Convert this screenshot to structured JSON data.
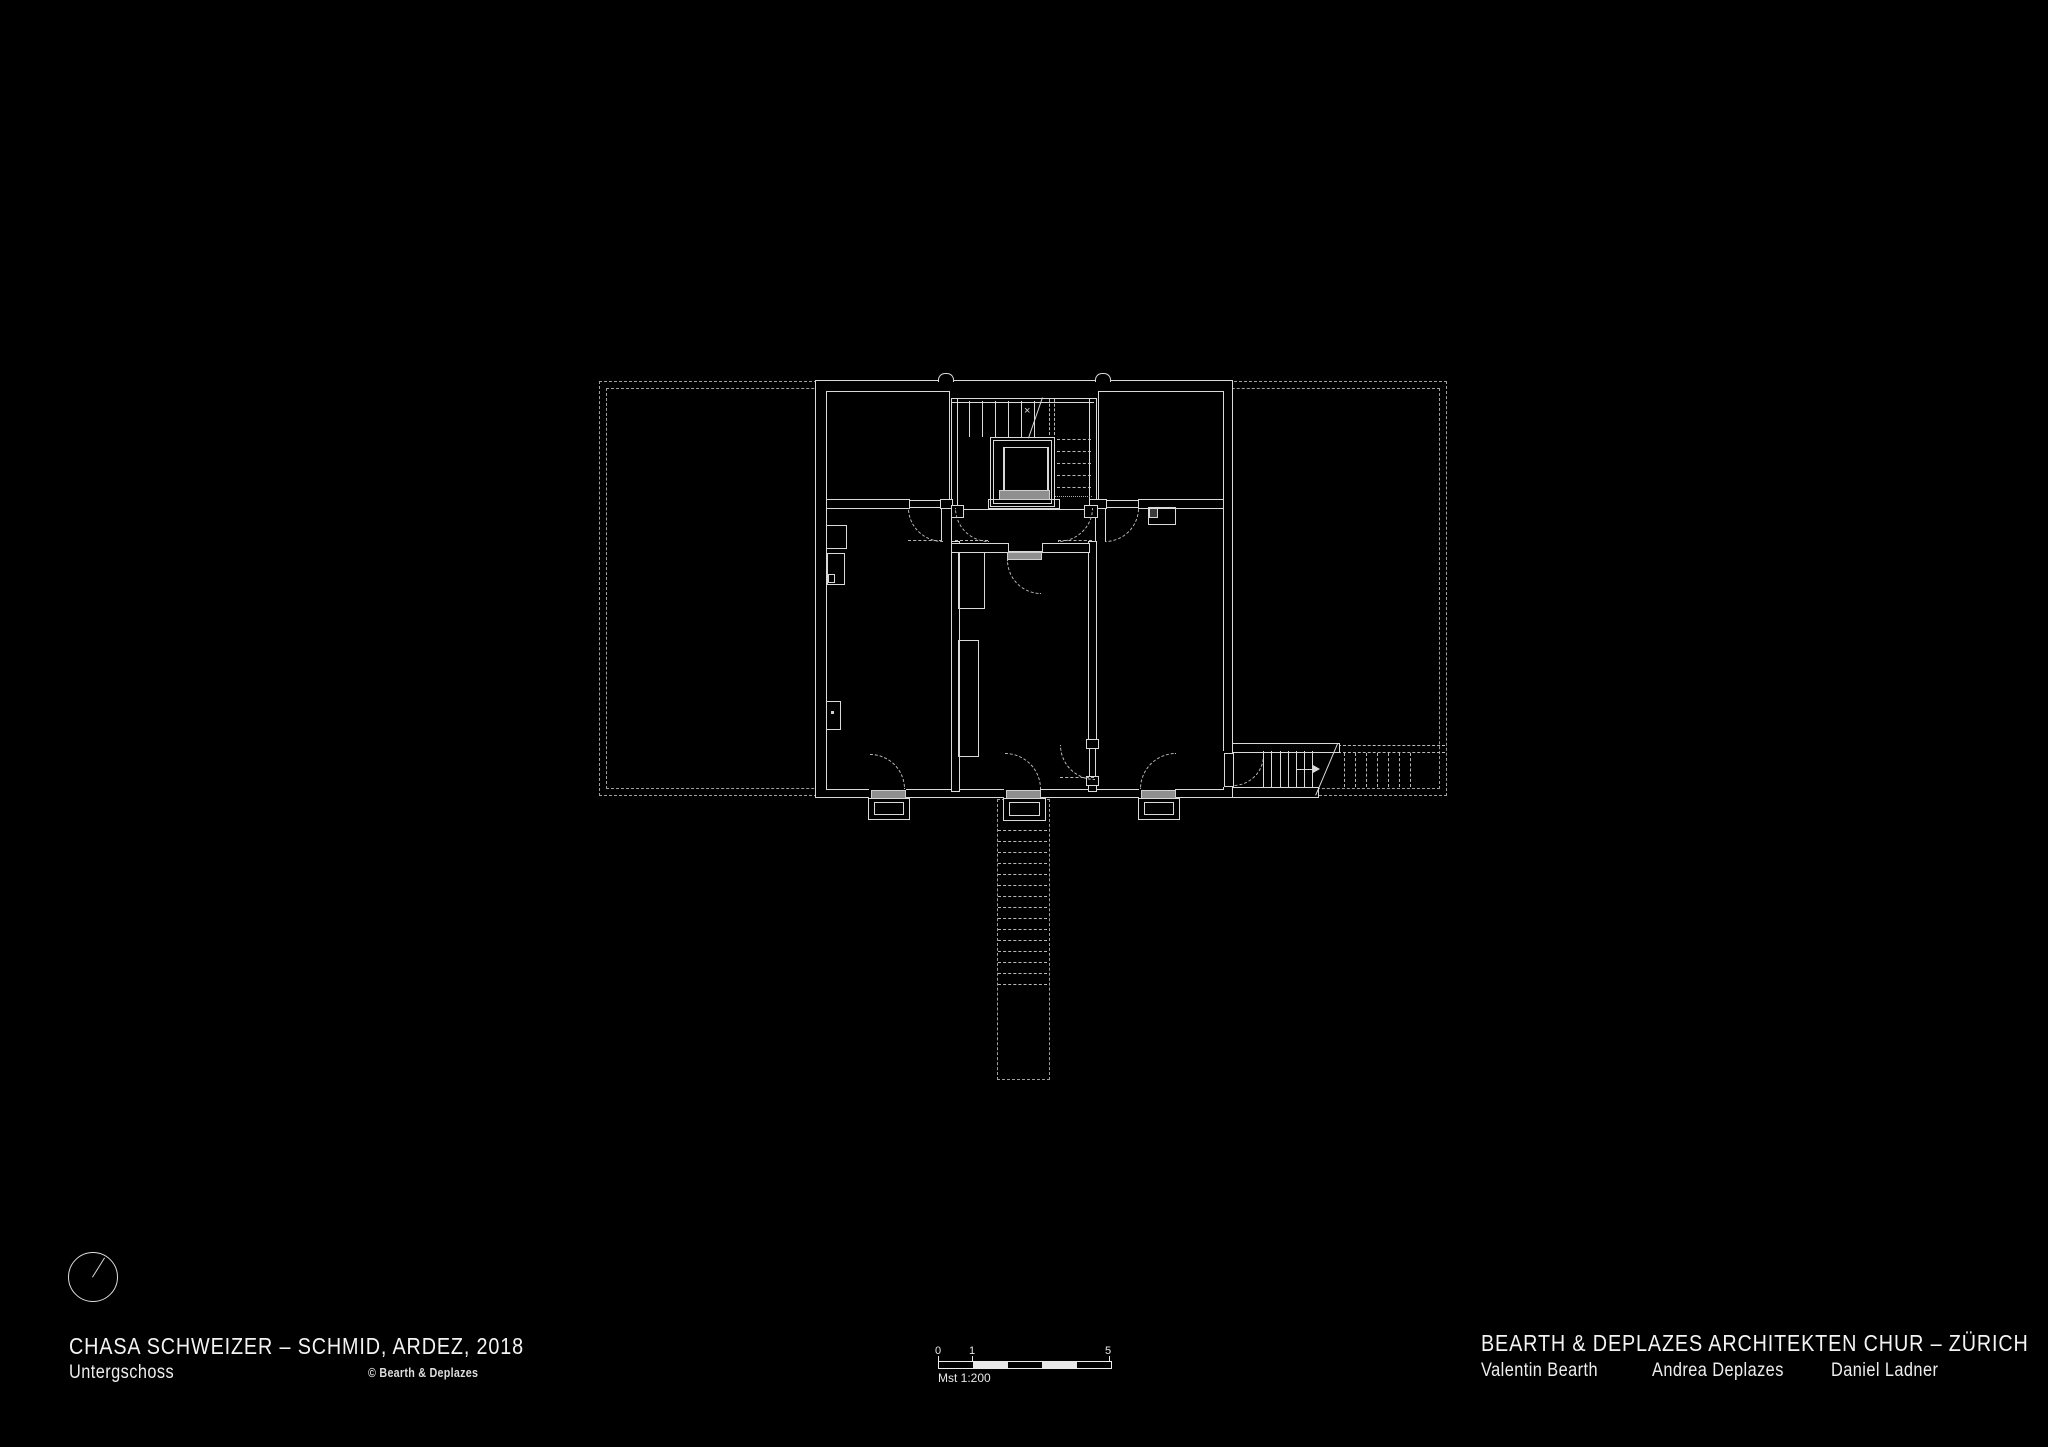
{
  "page": {
    "background": "#000000",
    "plan_line_color": "#d9d9d9",
    "dashed_line_color": "#9f9f9f",
    "door_fill_color": "#8f8f8f"
  },
  "title_block": {
    "project": "CHASA SCHWEIZER – SCHMID, ARDEZ, 2018",
    "floor": "Untergschoss",
    "copyright": "© Bearth & Deplazes"
  },
  "firm_block": {
    "firm": "BEARTH & DEPLAZES ARCHITEKTEN CHUR – ZÜRICH",
    "partners": [
      "Valentin Bearth",
      "Andrea Deplazes",
      "Daniel Ladner"
    ]
  },
  "scale_bar": {
    "tick_0": "0",
    "tick_1": "1",
    "tick_5": "5",
    "label": "Mst 1:200"
  }
}
